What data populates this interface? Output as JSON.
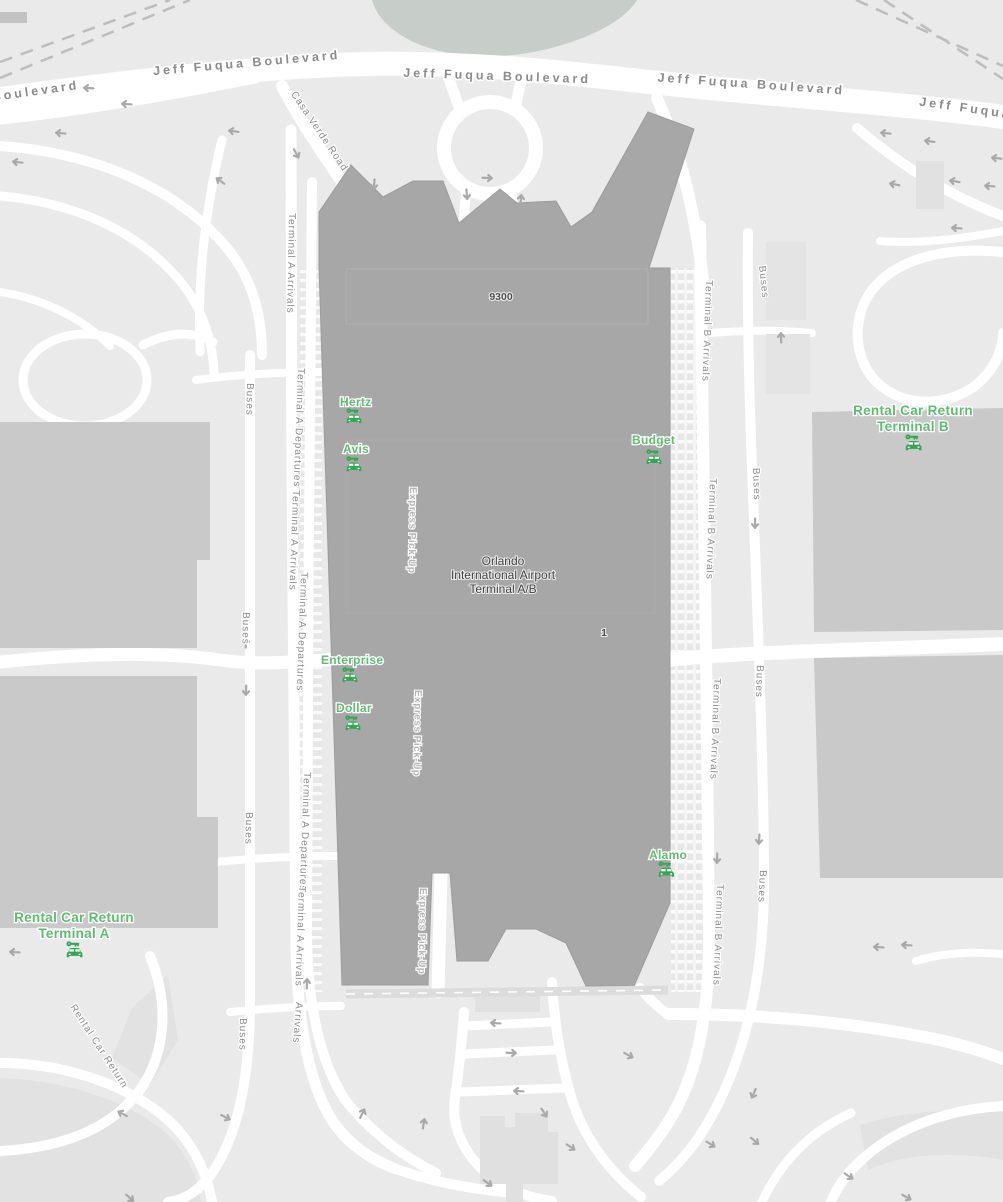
{
  "map": {
    "roads": {
      "jeff_fuqua_boulevard": "Jeff Fuqua Boulevard",
      "jeff_fuqua": "Jeff Fuqua",
      "boulevard": "Boulevard",
      "casa_verde_road": "Casa Verde Road",
      "terminal_a_arrivals": "Terminal A Arrivals",
      "terminal_a_departures": "Terminal A Departures",
      "terminal_b_arrivals": "Terminal B Arrivals",
      "buses": "Buses",
      "arrivals": "Arrivals",
      "express_pick_up": "Express Pick-Up",
      "rental_car_return": "Rental Car Return"
    },
    "buildings": {
      "terminal_name": {
        "line1": "Orlando",
        "line2": "International Airport",
        "line3": "Terminal A/B"
      },
      "terminal_number": "9300",
      "door_number": "1"
    },
    "rental_pois": {
      "hertz": "Hertz",
      "avis": "Avis",
      "budget": "Budget",
      "enterprise": "Enterprise",
      "dollar": "Dollar",
      "alamo": "Alamo",
      "rental_return_b": {
        "line1": "Rental Car Return",
        "line2": "Terminal B"
      },
      "rental_return_a": {
        "line1": "Rental Car Return",
        "line2": "Terminal A"
      }
    },
    "icons": {
      "car_rental": "car-with-key",
      "direction_arrow": "one-way-arrow"
    },
    "colors": {
      "land": "#eaeaea",
      "land_shade": "#e2e2e2",
      "road": "#ffffff",
      "water": "#c7cdc9",
      "terminal_fill": "#a7a7a7",
      "terminal_outline": "#9c9c9c",
      "building_fill": "#c9c9c9",
      "building_light": "#e1e1e1",
      "road_label": "#8b8b8b",
      "express_label": "#b5b5b5",
      "building_label": "#3e3e3e",
      "poi_green": "#5cbd6d",
      "poi_icon_green": "#2fa84f",
      "arrow": "#a9a9a9",
      "rail_dash": "#bdbdbd"
    }
  }
}
